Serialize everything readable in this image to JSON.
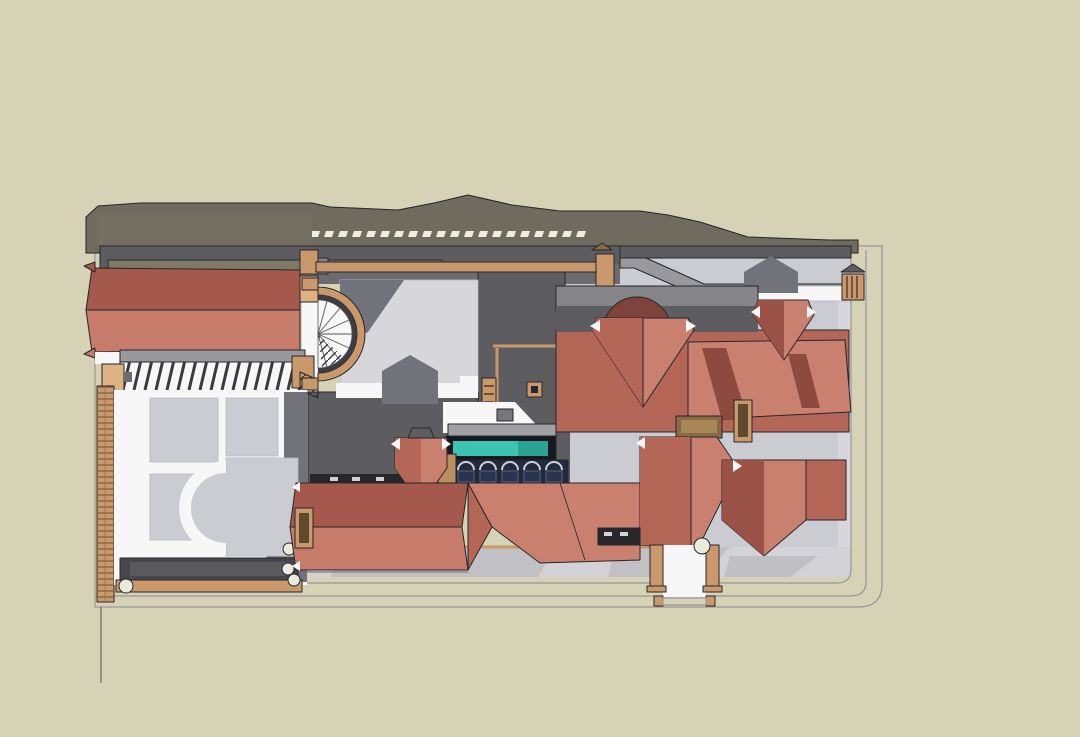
{
  "meta": {
    "title": "Top-down shaded render of a courtyard villa compound",
    "description": "Plan view of a 3D architectural model: walled plot with terracotta hip-roof houses, a domed pavilion, flat gray service roofs, a gabled west wing with pergola and spiral stair, parterre garden, teal lap pool over an arched arcade, driveways, gates and boundary walls on a beige backdrop",
    "view": "top-down plan view",
    "render_style": "shaded 3D model viewport, no visible text or UI"
  },
  "canvas": {
    "width": 1080,
    "height": 737
  },
  "palette": {
    "canvas_beige": "#d6d2b6",
    "plot_white": "#f3f3f5",
    "boundary_line": "#96969b",
    "court_gray": "#cbccd1",
    "court_gray_light": "#d7d7db",
    "driveway_gray": "#d3d3d7",
    "shadow_gray": "#72727a",
    "roof_flat_dark": "#5d5d61",
    "roof_flat_mid": "#6c6c70",
    "roof_flat_light": "#858489",
    "wall_gray": "#98989d",
    "neighbor_olive": "#6f6b5e",
    "neighbor_olive_light": "#7a7668",
    "olive_strip": "#7e7a67",
    "roof_red_light": "#c9806f",
    "roof_red_mid": "#b46757",
    "roof_red_dark": "#9a5146",
    "roof_red_deep": "#7e443c",
    "gable_red_top": "#a5594c",
    "gable_red_bottom": "#c77b6a",
    "wood_tan": "#c9996c",
    "wood_tan_light": "#dfb284",
    "wood_brown": "#8a6a45",
    "wood_dark": "#5f4a2e",
    "pool_teal": "#3cc4b2",
    "pool_teal_dark": "#2aa394",
    "pool_frame": "#14181f",
    "window_navy": "#2a3350",
    "arcade_dark": "#232a3e",
    "ink": "#26262b",
    "white_trim": "#f7f7f8",
    "sphere_white": "#eaeadf",
    "tile_white": "#efece3",
    "chimney_shadow": "#8f4a40"
  },
  "scene": {
    "background": "warm beige model backdrop",
    "elements": [
      {
        "name": "site-plot",
        "description": "white-walled plot with light gray courtyards, rounded bottom-right boundary corner"
      },
      {
        "name": "neighboring-roofline",
        "description": "olive-gray gabled roof mass of rear neighboring building along the top edge"
      },
      {
        "name": "ridge-tile-row",
        "description": "row of pale coping tiles on the rear wall ridge"
      },
      {
        "name": "rear-flat-roofs",
        "description": "dark gray flat roofs of the rear service wing"
      },
      {
        "name": "west-gable-roof",
        "description": "two-tone terracotta gabled roof of the west wing"
      },
      {
        "name": "pergola-beam",
        "description": "long tan timber beam across the rear courtyard wall with posts"
      },
      {
        "name": "pergola-walkway",
        "description": "slatted pergola walkway with tan end posts below the west gable"
      },
      {
        "name": "spiral-staircase",
        "description": "semicircular fan staircase bulging east from the west wing wall"
      },
      {
        "name": "parterre-garden",
        "description": "formal garden of gray panels with white paths and a semicircular walk"
      },
      {
        "name": "trellis-wall",
        "description": "tan slatted trellis wall along the west boundary"
      },
      {
        "name": "central-courtyard",
        "description": "light gray inner courtyard with cast shadows of a gabled dormer"
      },
      {
        "name": "lap-pool",
        "description": "teal lap pool in a dark frame on the central wing roof"
      },
      {
        "name": "arched-arcade",
        "description": "row of five arched navy windows below the pool edge"
      },
      {
        "name": "domed-pavilion",
        "description": "deep-red dome rising behind the main hip roof"
      },
      {
        "name": "main-house",
        "description": "large terracotta hip-roof house with chimneys and cast chimney shadows"
      },
      {
        "name": "lower-houses",
        "description": "southern cluster of terracotta hip and gable roofs with chimney"
      },
      {
        "name": "driveway",
        "description": "light gray driveway band along the southern courtyard"
      },
      {
        "name": "south-gate",
        "description": "south entry walkway between tan pillars with a small double-rail gate"
      },
      {
        "name": "east-gate",
        "description": "small tan gate on the east boundary walkway"
      },
      {
        "name": "finial-spheres",
        "description": "small white sphere finials on garden and gate posts"
      },
      {
        "name": "boundary-walls",
        "description": "parallel white boundary walls on east and south with rounded corner"
      },
      {
        "name": "survey-line",
        "description": "thin stray model edge line extending below the south-west corner"
      }
    ]
  }
}
